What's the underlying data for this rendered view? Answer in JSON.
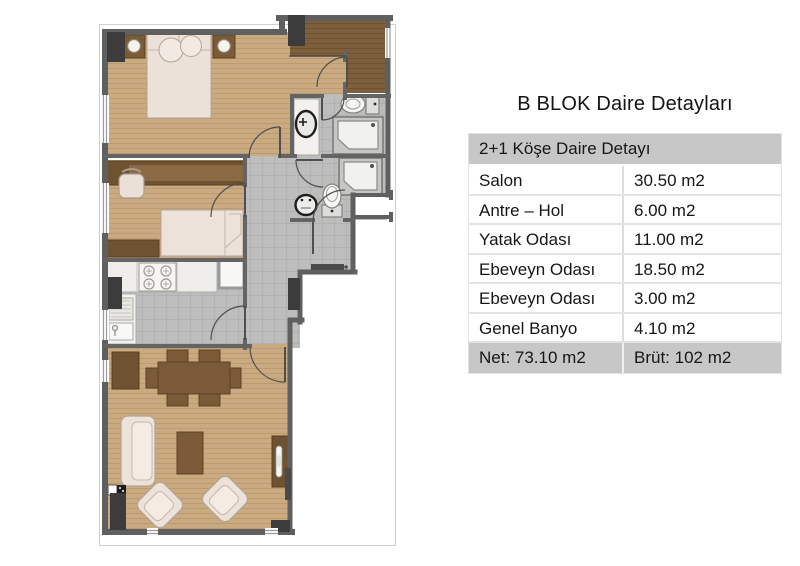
{
  "title": "B BLOK Daire Detayları",
  "table": {
    "header": "2+1 Köşe Daire Detayı",
    "rows": [
      {
        "label": "Salon",
        "value": "30.50 m2"
      },
      {
        "label": "Antre – Hol",
        "value": "6.00 m2"
      },
      {
        "label": "Yatak Odası",
        "value": "11.00 m2"
      },
      {
        "label": "Ebeveyn Odası",
        "value": "18.50 m2"
      },
      {
        "label": "Ebeveyn Odası",
        "value": "3.00 m2"
      },
      {
        "label": "Genel Banyo",
        "value": "4.10 m2"
      }
    ],
    "footer": {
      "net": "Net: 73.10 m2",
      "brut": "Brüt: 102 m2"
    }
  },
  "colors": {
    "table_header_bg": "#c7c7c7",
    "row_bg": "#ffffff",
    "text": "#161616",
    "wall": "#5f5f5f",
    "column": "#3c3c3c",
    "wood_light": "#c9aa81",
    "wood_dark": "#7e5f3b",
    "tile_gray": "#bdbdbd",
    "fabric": "#ece2da",
    "furniture_brown": "#7b5a38"
  },
  "floorplan": {
    "rooms": [
      "bedroom-1",
      "bedroom-2",
      "entry-hall",
      "bathroom-1",
      "bathroom-2",
      "hallway",
      "kitchen",
      "living-room"
    ],
    "fixtures": [
      "double-bed",
      "single-bed",
      "desk",
      "wardrobe",
      "kitchen-counter",
      "stove",
      "fridge",
      "kitchen-sink",
      "dining-table",
      "sofa",
      "armchairs",
      "coffee-table",
      "tv-unit",
      "toilets",
      "washbasins",
      "showers"
    ]
  }
}
